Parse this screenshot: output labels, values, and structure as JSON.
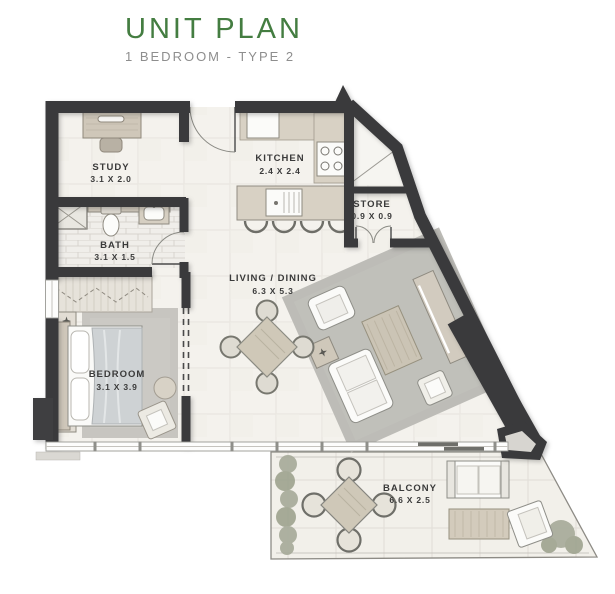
{
  "header": {
    "title": "UNIT PLAN",
    "subtitle": "1 BEDROOM - TYPE 2"
  },
  "rooms": {
    "study": {
      "name": "STUDY",
      "dims": "3.1 X 2.0"
    },
    "kitchen": {
      "name": "KITCHEN",
      "dims": "2.4 X 2.4"
    },
    "store": {
      "name": "STORE",
      "dims": "0.9 X 0.9"
    },
    "bath": {
      "name": "BATH",
      "dims": "3.1 X 1.5"
    },
    "living_dining": {
      "name": "LIVING / DINING",
      "dims": "6.3 X 5.3"
    },
    "bedroom": {
      "name": "BEDROOM",
      "dims": "3.1 X 3.9"
    },
    "balcony": {
      "name": "BALCONY",
      "dims": "6.6 X 2.5"
    }
  },
  "colors": {
    "accent_green": "#447D41",
    "subtitle_gray": "#8E8E8E",
    "wall": "#3A3A3C",
    "floor": "#F4F2ED",
    "rug": "#BDBCB7",
    "wood": "#D8D1C4",
    "plant": "#A6AA99",
    "label": "#3A3A3A"
  }
}
